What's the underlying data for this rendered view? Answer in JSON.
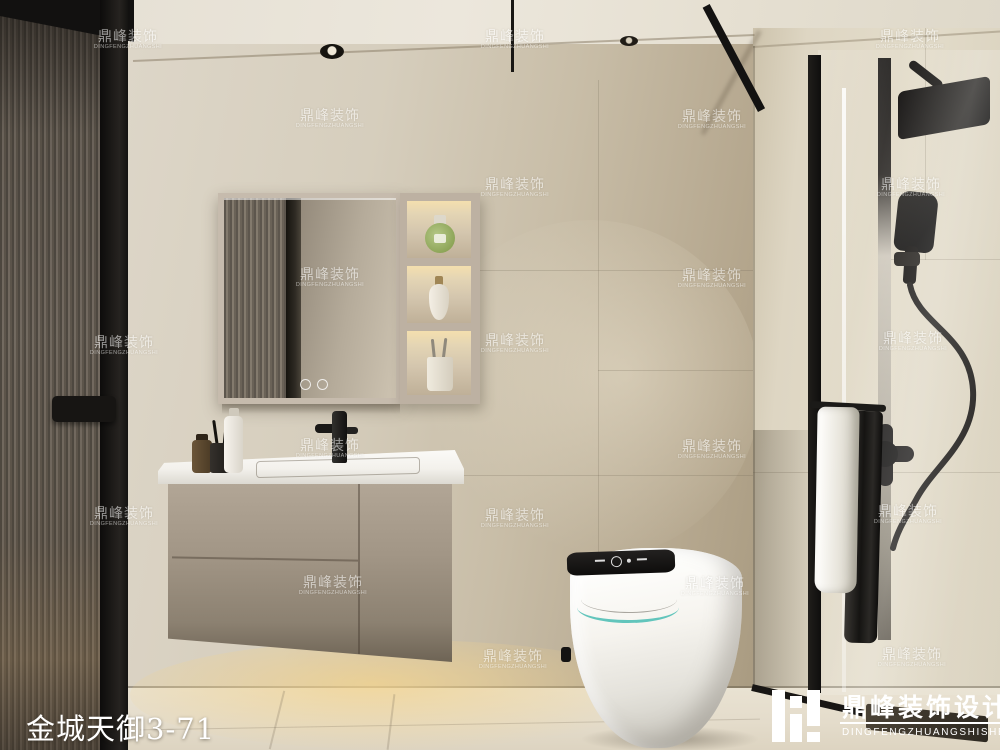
{
  "caption": {
    "project_title": "金城天御3-71"
  },
  "watermark": {
    "text_cn": "鼎峰装饰",
    "text_en": "DINGFENGZHUANGSHI",
    "positions": [
      [
        128,
        40
      ],
      [
        515,
        40
      ],
      [
        910,
        40
      ],
      [
        330,
        119
      ],
      [
        712,
        120
      ],
      [
        515,
        188
      ],
      [
        911,
        188
      ],
      [
        330,
        278
      ],
      [
        712,
        279
      ],
      [
        124,
        346
      ],
      [
        515,
        344
      ],
      [
        913,
        342
      ],
      [
        330,
        449
      ],
      [
        712,
        450
      ],
      [
        124,
        517
      ],
      [
        515,
        519
      ],
      [
        908,
        515
      ],
      [
        333,
        586
      ],
      [
        715,
        587
      ],
      [
        513,
        660
      ],
      [
        912,
        658
      ]
    ]
  },
  "brand_badge": {
    "name_cn": "鼎峰装饰设计",
    "name_en": "DINGFENGZHUANGSHISHEJI"
  },
  "colors": {
    "wall": "#cfc5b2",
    "ceiling": "#e7e1d4",
    "floor": "#e6dfcf",
    "cabinet_taupe": "#9d9183",
    "fixture_black": "#1b1a18",
    "toilet_accent_teal": "#49bdb3",
    "warm_glow": "#f0dcaa",
    "watermark_white": "#ffffff"
  }
}
